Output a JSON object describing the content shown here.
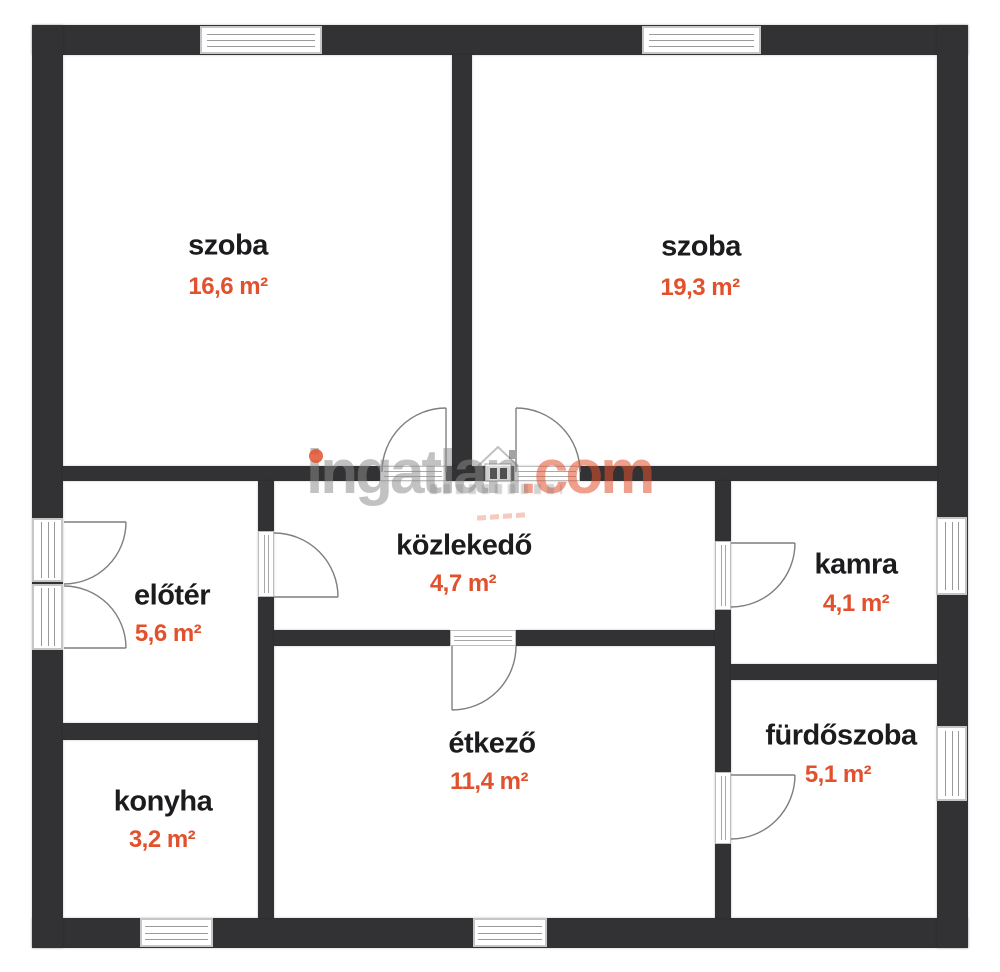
{
  "watermark": {
    "name": "ingatlan",
    "tld": ".com",
    "gray_color": "#8a8a8a",
    "orange_color": "#e0522d",
    "house_icon": "house-logo"
  },
  "colors": {
    "wall": "#323234",
    "room_label": "#1c1c1e",
    "room_area": "#e2512d",
    "door_stroke": "#7f7f7f",
    "window_frame": "#c6c6c6",
    "window_line": "#9a9a9a",
    "background": "#ffffff"
  },
  "rooms": [
    {
      "id": "szoba-1",
      "label": "szoba",
      "area": "16,6 m²",
      "label_x": 228,
      "label_y": 246,
      "area_x": 228,
      "area_y": 287
    },
    {
      "id": "szoba-2",
      "label": "szoba",
      "area": "19,3 m²",
      "label_x": 701,
      "label_y": 247,
      "area_x": 700,
      "area_y": 288
    },
    {
      "id": "eloter",
      "label": "előtér",
      "area": "5,6 m²",
      "label_x": 172,
      "label_y": 596,
      "area_x": 168,
      "area_y": 634
    },
    {
      "id": "kozlekedo",
      "label": "közlekedő",
      "area": "4,7 m²",
      "label_x": 464,
      "label_y": 546,
      "area_x": 463,
      "area_y": 584
    },
    {
      "id": "kamra",
      "label": "kamra",
      "area": "4,1 m²",
      "label_x": 856,
      "label_y": 565,
      "area_x": 856,
      "area_y": 604
    },
    {
      "id": "konyha",
      "label": "konyha",
      "area": "3,2 m²",
      "label_x": 163,
      "label_y": 802,
      "area_x": 162,
      "area_y": 840
    },
    {
      "id": "etkezo",
      "label": "étkező",
      "area": "11,4 m²",
      "label_x": 492,
      "label_y": 744,
      "area_x": 489,
      "area_y": 782
    },
    {
      "id": "furdoszoba",
      "label": "fürdőszoba",
      "area": "5,1 m²",
      "label_x": 841,
      "label_y": 736,
      "area_x": 838,
      "area_y": 775
    }
  ],
  "floorplan": {
    "walls": [
      {
        "name": "outer-wall-top",
        "x": 32,
        "y": 25,
        "w": 936,
        "h": 30
      },
      {
        "name": "outer-wall-bottom",
        "x": 32,
        "y": 918,
        "w": 936,
        "h": 30
      },
      {
        "name": "outer-wall-left",
        "x": 32,
        "y": 25,
        "w": 31,
        "h": 923
      },
      {
        "name": "outer-wall-right",
        "x": 937,
        "y": 25,
        "w": 31,
        "h": 923
      },
      {
        "name": "wall-szoba-divider",
        "x": 452,
        "y": 55,
        "w": 20,
        "h": 426
      },
      {
        "name": "wall-middle-horizontal",
        "x": 63,
        "y": 466,
        "w": 874,
        "h": 15
      },
      {
        "name": "wall-elotter-kozlekedo",
        "x": 258,
        "y": 481,
        "w": 16,
        "h": 437
      },
      {
        "name": "wall-elotter-konyha",
        "x": 63,
        "y": 723,
        "w": 195,
        "h": 17
      },
      {
        "name": "wall-kozlekedo-etkezo-west",
        "x": 274,
        "y": 630,
        "w": 176,
        "h": 16
      },
      {
        "name": "wall-kozlekedo-etkezo-east",
        "x": 516,
        "y": 630,
        "w": 199,
        "h": 16
      },
      {
        "name": "wall-kamra-furdo-left",
        "x": 715,
        "y": 481,
        "w": 16,
        "h": 437
      },
      {
        "name": "wall-kamra-bottom",
        "x": 731,
        "y": 664,
        "w": 206,
        "h": 16
      }
    ],
    "windows": [
      {
        "name": "window-szoba1-top",
        "x": 200,
        "y": 26,
        "w": 122,
        "h": 28,
        "dir": "h"
      },
      {
        "name": "window-szoba2-top",
        "x": 642,
        "y": 26,
        "w": 119,
        "h": 28,
        "dir": "h"
      },
      {
        "name": "window-kamra-right",
        "x": 936,
        "y": 517,
        "w": 31,
        "h": 78,
        "dir": "v"
      },
      {
        "name": "window-furdoszoba-right",
        "x": 936,
        "y": 726,
        "w": 31,
        "h": 75,
        "dir": "v"
      },
      {
        "name": "window-konyha-bottom",
        "x": 140,
        "y": 918,
        "w": 73,
        "h": 29,
        "dir": "h"
      },
      {
        "name": "window-etkezo-bottom",
        "x": 473,
        "y": 918,
        "w": 74,
        "h": 29,
        "dir": "h"
      },
      {
        "name": "entry-door-sill-upper",
        "x": 32,
        "y": 518,
        "w": 31,
        "h": 64,
        "dir": "v"
      },
      {
        "name": "entry-door-sill-lower",
        "x": 32,
        "y": 584,
        "w": 31,
        "h": 66,
        "dir": "v"
      }
    ],
    "sills": [
      {
        "name": "doorway-szoba1",
        "x": 380,
        "y": 466,
        "w": 66,
        "h": 15,
        "dir": "h"
      },
      {
        "name": "doorway-szoba2",
        "x": 514,
        "y": 466,
        "w": 66,
        "h": 15,
        "dir": "h"
      },
      {
        "name": "doorway-elotter",
        "x": 258,
        "y": 531,
        "w": 16,
        "h": 66,
        "dir": "v"
      },
      {
        "name": "doorway-etkezo",
        "x": 450,
        "y": 630,
        "w": 66,
        "h": 16,
        "dir": "h"
      },
      {
        "name": "doorway-kamra",
        "x": 715,
        "y": 541,
        "w": 16,
        "h": 69,
        "dir": "v"
      },
      {
        "name": "doorway-furdoszoba",
        "x": 715,
        "y": 772,
        "w": 16,
        "h": 72,
        "dir": "v"
      }
    ],
    "doors": [
      {
        "name": "door-szoba1",
        "hinge": [
          446,
          472
        ],
        "leaf": [
          446,
          408
        ],
        "arc_end": [
          382,
          472
        ],
        "r": 64,
        "sweep": 0
      },
      {
        "name": "door-szoba2",
        "hinge": [
          516,
          472
        ],
        "leaf": [
          516,
          408
        ],
        "arc_end": [
          580,
          472
        ],
        "r": 64,
        "sweep": 1
      },
      {
        "name": "door-elotter-kozlekedo",
        "hinge": [
          274,
          597
        ],
        "leaf": [
          338,
          597
        ],
        "arc_end": [
          274,
          533
        ],
        "r": 64,
        "sweep": 0
      },
      {
        "name": "door-kozlekedo-etkezo",
        "hinge": [
          452,
          646
        ],
        "leaf": [
          452,
          710
        ],
        "arc_end": [
          516,
          646
        ],
        "r": 64,
        "sweep": 0
      },
      {
        "name": "door-kamra",
        "hinge": [
          731,
          543
        ],
        "leaf": [
          795,
          543
        ],
        "arc_end": [
          731,
          607
        ],
        "r": 64,
        "sweep": 1
      },
      {
        "name": "door-furdoszoba",
        "hinge": [
          731,
          775
        ],
        "leaf": [
          795,
          775
        ],
        "arc_end": [
          731,
          839
        ],
        "r": 64,
        "sweep": 1
      },
      {
        "name": "entry-door-upper-leaf",
        "hinge": [
          64,
          522
        ],
        "leaf": [
          126,
          522
        ],
        "arc_end": [
          64,
          584
        ],
        "r": 62,
        "sweep": 1
      },
      {
        "name": "entry-door-lower-leaf",
        "hinge": [
          64,
          648
        ],
        "leaf": [
          126,
          648
        ],
        "arc_end": [
          64,
          586
        ],
        "r": 62,
        "sweep": 0
      }
    ]
  }
}
